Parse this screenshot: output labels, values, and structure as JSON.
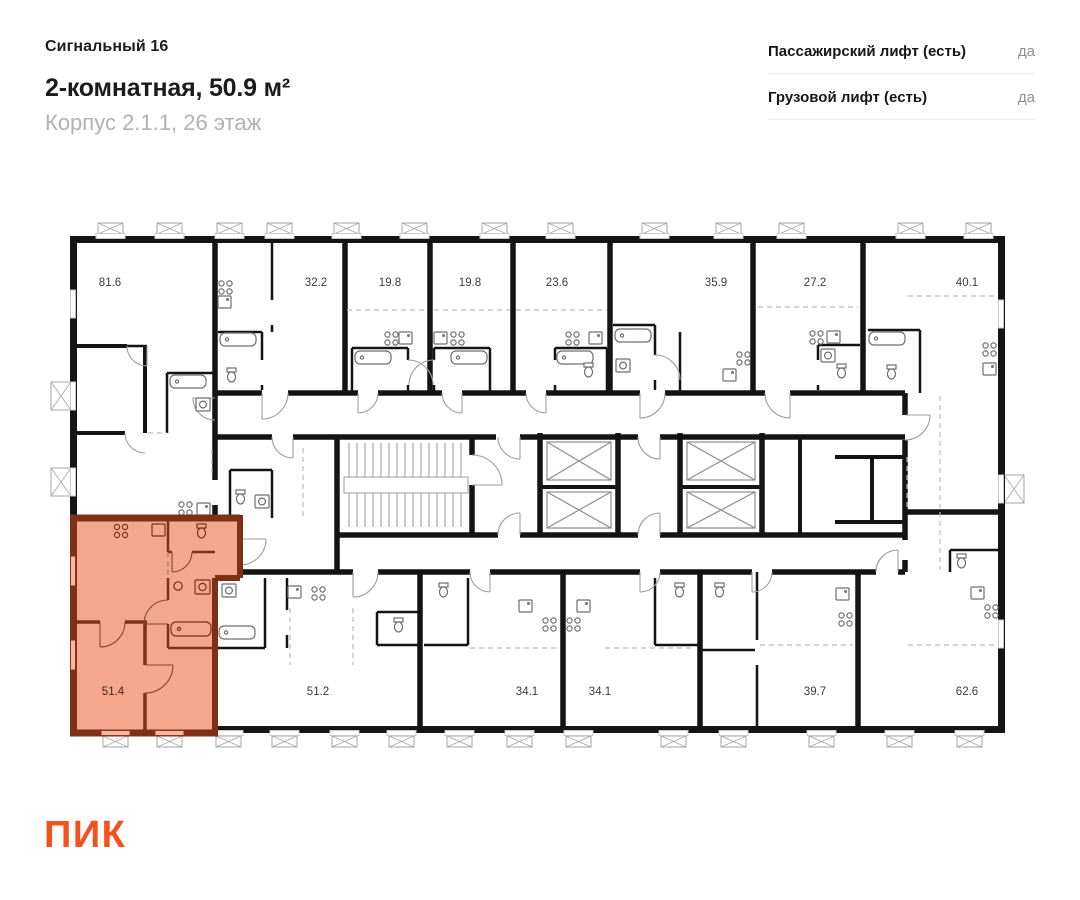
{
  "header": {
    "project": "Сигнальный 16",
    "title": "2-комнатная, 50.9 м²",
    "subtitle": "Корпус 2.1.1, 26 этаж"
  },
  "lifts": {
    "rows": [
      {
        "label": "Пассажирский лифт (есть)",
        "value": "да"
      },
      {
        "label": "Грузовой лифт (есть)",
        "value": "да"
      }
    ]
  },
  "plan": {
    "top_units": [
      {
        "area": "81.6"
      },
      {
        "area": "32.2"
      },
      {
        "area": "19.8"
      },
      {
        "area": "19.8"
      },
      {
        "area": "23.6"
      },
      {
        "area": "35.9"
      },
      {
        "area": "27.2"
      },
      {
        "area": "40.1"
      }
    ],
    "bottom_units": [
      {
        "area": "51.4",
        "highlighted": true
      },
      {
        "area": "51.2"
      },
      {
        "area": "34.1"
      },
      {
        "area": "34.1"
      },
      {
        "area": "39.7"
      },
      {
        "area": "62.6"
      }
    ],
    "highlighted_area": "51.4",
    "colors": {
      "highlight_fill": "#F5A78D",
      "highlight_wall": "#7E3116",
      "wall": "#141414"
    }
  },
  "logo": {
    "text": "ПИК",
    "color": "#F4521D"
  }
}
